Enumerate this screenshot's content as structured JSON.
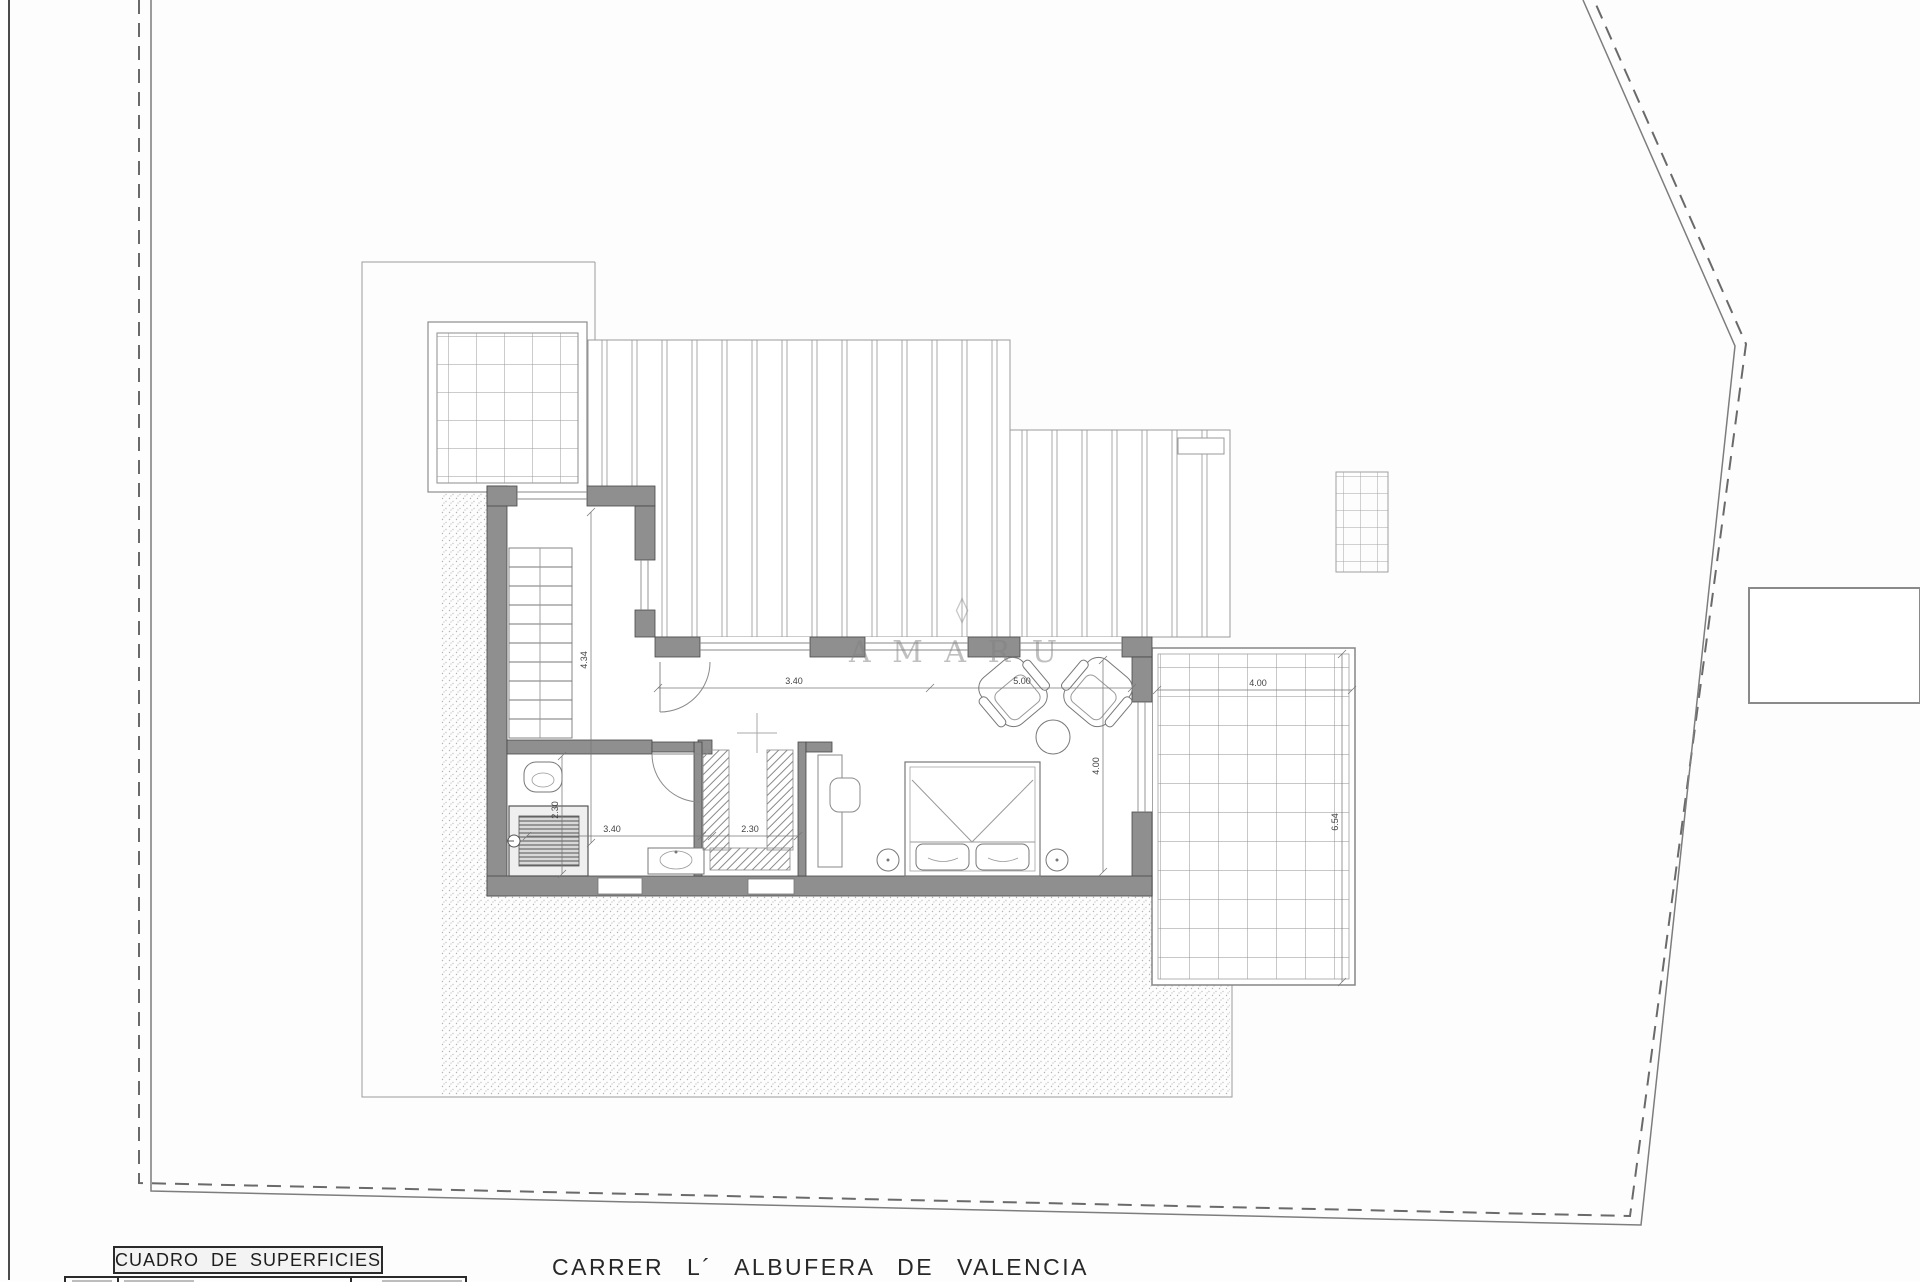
{
  "plan": {
    "watermark_text": "A M A R U",
    "dimensions": {
      "stair_hall": "4.34",
      "corridor_width": "3.40",
      "living_width": "5.00",
      "bedroom_depth": "4.00",
      "bathroom_width": "3.40",
      "bathroom_depth": "2.30",
      "closet_width": "2.30",
      "terrace_width": "4.00",
      "terrace_depth": "6.54"
    }
  },
  "footer": {
    "surface_table_title": "CUADRO DE SUPERFICIES",
    "street_name": "CARRER L´ ALBUFERA DE VALENCIA"
  },
  "colors": {
    "wall": "#8f8f8f",
    "boundary": "#666666",
    "dim": "#555555"
  }
}
